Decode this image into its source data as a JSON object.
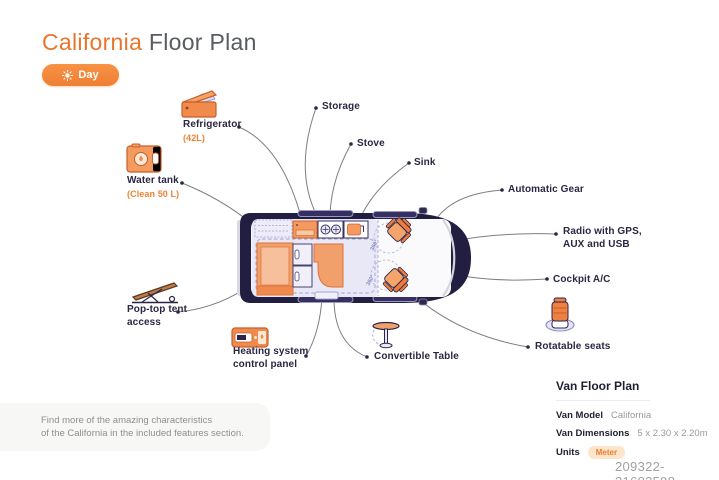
{
  "header": {
    "title_highlight": "California",
    "title_rest": " Floor Plan",
    "mode_button": {
      "label": "Day",
      "icon": "sun-icon"
    }
  },
  "callouts": {
    "refrigerator": {
      "label": "Refrigerator",
      "sublabel": "(42L)"
    },
    "water_tank": {
      "label": "Water tank",
      "sublabel": "(Clean 50 L)"
    },
    "storage": {
      "label": "Storage"
    },
    "stove": {
      "label": "Stove"
    },
    "sink": {
      "label": "Sink"
    },
    "automatic_gear": {
      "label": "Automatic Gear"
    },
    "radio": {
      "label": "Radio with GPS, AUX and USB"
    },
    "cockpit_ac": {
      "label": "Cockpit A/C"
    },
    "rotatable_seats": {
      "label": "Rotatable seats"
    },
    "convertible_table": {
      "label": "Convertible Table"
    },
    "heating_system": {
      "label": "Heating system control panel"
    },
    "pop_top": {
      "label": "Pop-top tent access"
    }
  },
  "van": {
    "rotation_label": "360°"
  },
  "footnote": {
    "line1": "Find more of the amazing characteristics",
    "line2": "of the California in the included features section."
  },
  "info_panel": {
    "heading": "Van Floor Plan",
    "rows": [
      {
        "label": "Van Model",
        "value": "California"
      },
      {
        "label": "Van Dimensions",
        "value": "5 x 2.30 x 2.20m"
      },
      {
        "label": "Units",
        "value": "Meter"
      }
    ]
  },
  "watermark": "209322-21683598",
  "colors": {
    "accent_orange": "#EF8136",
    "dark_navy": "#221E41",
    "lavender": "#E9E8F6",
    "muted_gray": "#8F8F8F"
  }
}
